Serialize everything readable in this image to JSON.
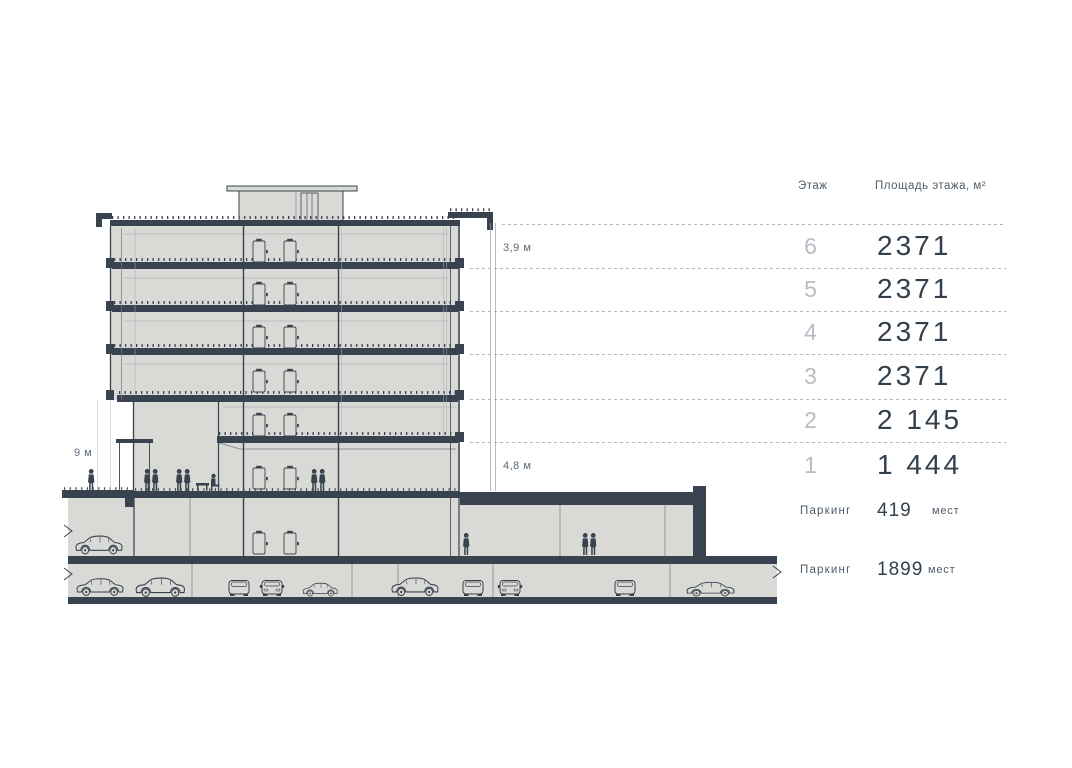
{
  "drawing": {
    "dim_floor_height": "3,9 м",
    "dim_ground_height": "4,8 м",
    "dim_lobby_height": "9 м"
  },
  "table": {
    "header": {
      "floor": "Этаж",
      "area": "Площадь этажа, м²"
    },
    "floors": [
      {
        "label": "6",
        "area": "2371"
      },
      {
        "label": "5",
        "area": "2371"
      },
      {
        "label": "4",
        "area": "2371"
      },
      {
        "label": "3",
        "area": "2371"
      },
      {
        "label": "2",
        "area": "2 145"
      },
      {
        "label": "1",
        "area": "1 444"
      }
    ],
    "parking": [
      {
        "label": "Паркинг",
        "value": "419",
        "unit": "мест"
      },
      {
        "label": "Паркинг",
        "value": "1899",
        "unit": "мест"
      }
    ]
  },
  "colors": {
    "dark": "#39434f",
    "wall_fill": "#d9d9d6",
    "muted_text": "#4e5c6a",
    "floor_number": "#b7bdc4",
    "dashed_line": "#aeb6bd"
  }
}
